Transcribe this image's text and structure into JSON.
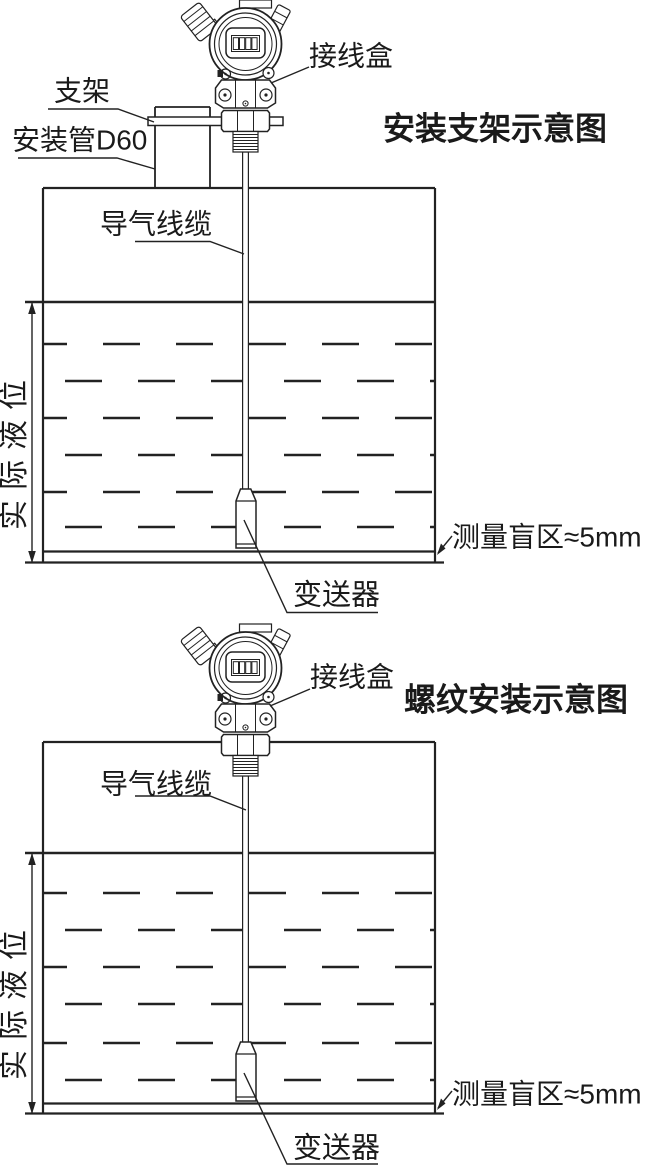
{
  "bracket": {
    "title": "安装支架示意图",
    "labels": {
      "junction_box": "接线盒",
      "bracket": "支架",
      "mounting_pipe": "安装管D60",
      "air_cable": "导气线缆",
      "actual_level": "实际液位",
      "blind_zone": "测量盲区≈5mm",
      "transmitter": "变送器"
    }
  },
  "threaded": {
    "title": "螺纹安装示意图",
    "labels": {
      "junction_box": "接线盒",
      "air_cable": "导气线缆",
      "actual_level": "实际液位",
      "blind_zone": "测量盲区≈5mm",
      "transmitter": "变送器"
    }
  },
  "colors": {
    "line": "#222222",
    "text": "#1a1a1a",
    "background": "#ffffff"
  }
}
